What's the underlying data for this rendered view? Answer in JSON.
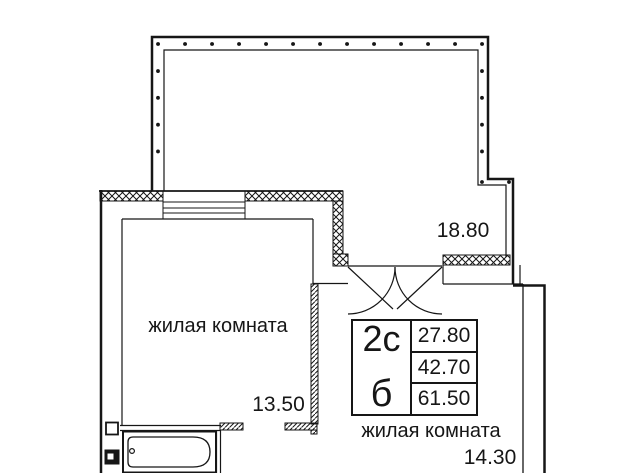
{
  "floor_plan": {
    "terrace": {
      "dimension": "18.80"
    },
    "living_room_left": {
      "label": "жилая комната",
      "dimension": "13.50"
    },
    "living_room_right": {
      "label": "жилая комната",
      "dimension": "14.30"
    },
    "legend": {
      "plan_type": "2с",
      "section": "б",
      "values": [
        "27.80",
        "42.70",
        "61.50"
      ]
    },
    "colors": {
      "ink": "#161616",
      "background": "#ffffff"
    }
  }
}
